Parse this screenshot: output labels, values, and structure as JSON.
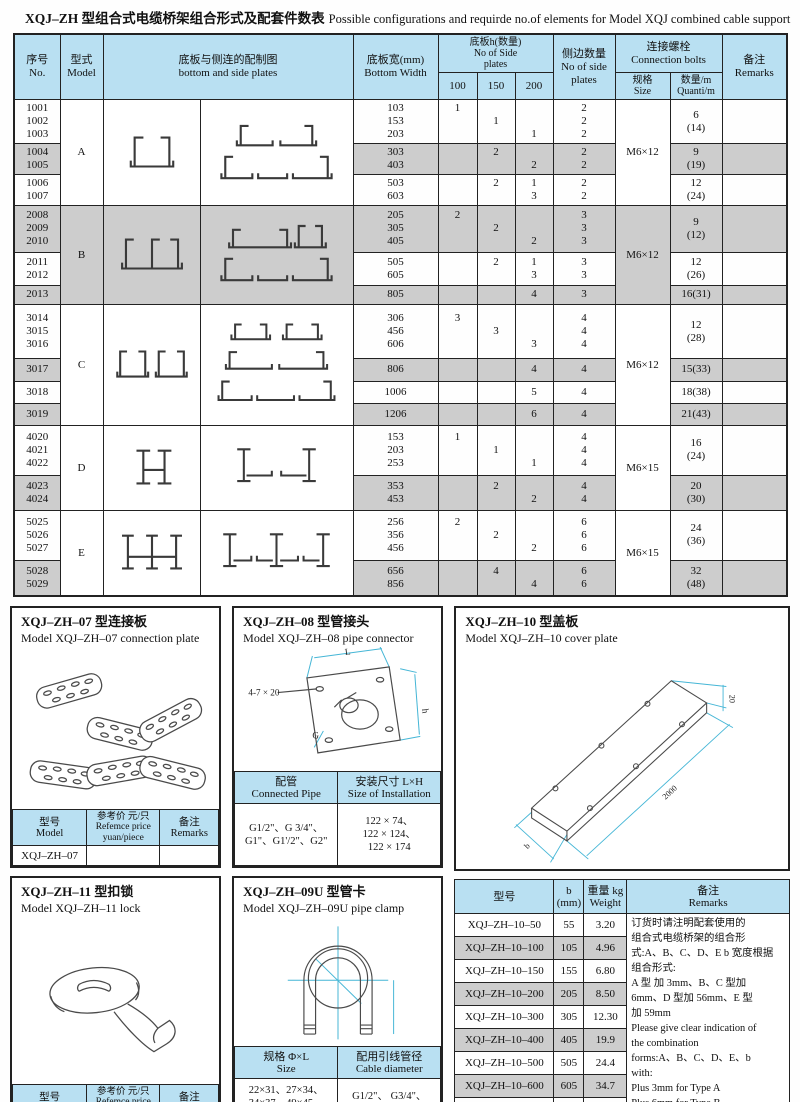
{
  "title": {
    "zh": "XQJ–ZH 型组合式电缆桥架组合形式及配套件数表",
    "en": "Possible configurations and requirde no.of elements for Model XQJ combined cable support"
  },
  "main_table": {
    "header": {
      "no": "序号\nNo.",
      "model": "型式\nModel",
      "plates": "底板与侧连的配制图\nbottom and side plates",
      "width": "底板宽(mm)\nBottom Width",
      "h_plates": "底板h(数量)\nNo of Side\nplates",
      "h100": "100",
      "h150": "150",
      "h200": "200",
      "sides": "侧边数量\nNo of side\nplates",
      "bolts": "连接螺栓\nConnection bolts",
      "bolt_size": "规格\nSize",
      "bolt_qty": "数量/m\nQuanti/m",
      "remarks": "备注\nRemarks"
    },
    "groups": [
      {
        "model": "A",
        "bolt_size": "M6×12",
        "subs": [
          {
            "models": [
              "1001",
              "1002",
              "1003"
            ],
            "widths": [
              "103",
              "153",
              "203"
            ],
            "h100": [
              "1",
              "",
              ""
            ],
            "h150": [
              "",
              "1",
              ""
            ],
            "h200": [
              "",
              "",
              "1"
            ],
            "sides": [
              "2",
              "2",
              "2"
            ],
            "qty": "6\n(14)"
          },
          {
            "models": [
              "1004",
              "1005"
            ],
            "widths": [
              "303",
              "403"
            ],
            "h100": [
              "",
              ""
            ],
            "h150": [
              "2",
              ""
            ],
            "h200": [
              "",
              "2"
            ],
            "sides": [
              "2",
              "2"
            ],
            "qty": "9\n(19)"
          },
          {
            "models": [
              "1006",
              "1007"
            ],
            "widths": [
              "503",
              "603"
            ],
            "h100": [
              "",
              ""
            ],
            "h150": [
              "2",
              ""
            ],
            "h200": [
              "1",
              "3"
            ],
            "sides": [
              "2",
              "2"
            ],
            "qty": "12\n(24)"
          }
        ]
      },
      {
        "model": "B",
        "bolt_size": "M6×12",
        "subs": [
          {
            "models": [
              "2008",
              "2009",
              "2010"
            ],
            "widths": [
              "205",
              "305",
              "405"
            ],
            "h100": [
              "2",
              "",
              ""
            ],
            "h150": [
              "",
              "2",
              ""
            ],
            "h200": [
              "",
              "",
              "2"
            ],
            "sides": [
              "3",
              "3",
              "3"
            ],
            "qty": "9\n(12)"
          },
          {
            "models": [
              "2011",
              "2012"
            ],
            "widths": [
              "505",
              "605"
            ],
            "h100": [
              "",
              ""
            ],
            "h150": [
              "2",
              ""
            ],
            "h200": [
              "1",
              "3"
            ],
            "sides": [
              "3",
              "3"
            ],
            "qty": "12\n(26)"
          },
          {
            "models": [
              "2013"
            ],
            "widths": [
              "805"
            ],
            "h100": [
              ""
            ],
            "h150": [
              ""
            ],
            "h200": [
              "4"
            ],
            "sides": [
              "3"
            ],
            "qty": "16(31)"
          }
        ]
      },
      {
        "model": "C",
        "bolt_size": "M6×12",
        "subs": [
          {
            "models": [
              "3014",
              "3015",
              "3016"
            ],
            "widths": [
              "306",
              "456",
              "606"
            ],
            "h100": [
              "3",
              "",
              ""
            ],
            "h150": [
              "",
              "3",
              ""
            ],
            "h200": [
              "",
              "",
              "3"
            ],
            "sides": [
              "4",
              "4",
              "4"
            ],
            "qty": "12\n(28)"
          },
          {
            "models": [
              "3017"
            ],
            "widths": [
              "806"
            ],
            "h100": [
              ""
            ],
            "h150": [
              ""
            ],
            "h200": [
              "4"
            ],
            "sides": [
              "4"
            ],
            "qty": "15(33)"
          },
          {
            "models": [
              "3018"
            ],
            "widths": [
              "1006"
            ],
            "h100": [
              ""
            ],
            "h150": [
              ""
            ],
            "h200": [
              "5"
            ],
            "sides": [
              "4"
            ],
            "qty": "18(38)"
          },
          {
            "models": [
              "3019"
            ],
            "widths": [
              "1206"
            ],
            "h100": [
              ""
            ],
            "h150": [
              ""
            ],
            "h200": [
              "6"
            ],
            "sides": [
              "4"
            ],
            "qty": "21(43)"
          }
        ]
      },
      {
        "model": "D",
        "bolt_size": "M6×15",
        "subs": [
          {
            "models": [
              "4020",
              "4021",
              "4022"
            ],
            "widths": [
              "153",
              "203",
              "253"
            ],
            "h100": [
              "1",
              "",
              ""
            ],
            "h150": [
              "",
              "1",
              ""
            ],
            "h200": [
              "",
              "",
              "1"
            ],
            "sides": [
              "4",
              "4",
              "4"
            ],
            "qty": "16\n(24)"
          },
          {
            "models": [
              "4023",
              "4024"
            ],
            "widths": [
              "353",
              "453"
            ],
            "h100": [
              "",
              ""
            ],
            "h150": [
              "2",
              ""
            ],
            "h200": [
              "",
              "2"
            ],
            "sides": [
              "4",
              "4"
            ],
            "qty": "20\n(30)"
          }
        ]
      },
      {
        "model": "E",
        "bolt_size": "M6×15",
        "subs": [
          {
            "models": [
              "5025",
              "5026",
              "5027"
            ],
            "widths": [
              "256",
              "356",
              "456"
            ],
            "h100": [
              "2",
              "",
              ""
            ],
            "h150": [
              "",
              "2",
              ""
            ],
            "h200": [
              "",
              "",
              "2"
            ],
            "sides": [
              "6",
              "6",
              "6"
            ],
            "qty": "24\n(36)"
          },
          {
            "models": [
              "5028",
              "5029"
            ],
            "widths": [
              "656",
              "856"
            ],
            "h100": [
              "",
              ""
            ],
            "h150": [
              "4",
              ""
            ],
            "h200": [
              "",
              "4"
            ],
            "sides": [
              "6",
              "6"
            ],
            "qty": "32\n(48)"
          }
        ]
      }
    ]
  },
  "sections": {
    "zh07": {
      "title_zh": "XQJ–ZH–07 型连接板",
      "title_en": "Model XQJ–ZH–07 connection plate",
      "headers": [
        "型号\nModel",
        "参考价 元/只\nRefemce price\nyuan/piece",
        "备注\nRemarks"
      ],
      "row": [
        "XQJ–ZH–07",
        "",
        ""
      ]
    },
    "zh08": {
      "title_zh": "XQJ–ZH–08 型管接头",
      "title_en": "Model XQJ–ZH–08 pipe connector",
      "labels": {
        "holes": "4-7 × 20",
        "L": "L",
        "h": "h",
        "G": "G"
      },
      "headers": [
        "配管\nConnected Pipe",
        "安装尺寸 L×H\nSize of Installation"
      ],
      "row": [
        "G1/2\"、G 3/4\"、\nG1\"、G1'/2\"、G2\"",
        "122 × 74、\n122 × 124、\n122 × 174"
      ]
    },
    "zh10": {
      "title_zh": "XQJ–ZH–10 型盖板",
      "title_en": "Model XQJ–ZH–10 cover plate",
      "labels": {
        "thickness": "20",
        "length": "2000",
        "width": "b"
      }
    },
    "zh11": {
      "title_zh": "XQJ–ZH–11 型扣锁",
      "title_en": "Model XQJ–ZH–11 lock",
      "headers": [
        "型号\nModel",
        "参考价 元/只\nRefemce price\nyuan/piece",
        "备注\nRemarks"
      ],
      "row": [
        "XQJ–ZH–11",
        "",
        ""
      ]
    },
    "zh09u": {
      "title_zh": "XQJ–ZH–09U 型管卡",
      "title_en": "Model XQJ–ZH–09U pipe clamp",
      "headers": [
        "规格 Φ×L\nSize",
        "配用引线管径\nCable diameter"
      ],
      "row": [
        "22×31、27×34、\n34×37、49×45、\n61×50、76×57、\n89×64",
        "G1/2\"、 G3/4\"、\nG1\"、 G1'/2\"、\nG2\"、 G2'/2\"、 G3\""
      ]
    },
    "zh10_table": {
      "headers": [
        "型号",
        "b\n(mm)",
        "重量 kg\nWeight",
        "备注\nRemarks"
      ],
      "rows": [
        [
          "XQJ–ZH–10–50",
          "55",
          "3.20"
        ],
        [
          "XQJ–ZH–10–100",
          "105",
          "4.96"
        ],
        [
          "XQJ–ZH–10–150",
          "155",
          "6.80"
        ],
        [
          "XQJ–ZH–10–200",
          "205",
          "8.50"
        ],
        [
          "XQJ–ZH–10–300",
          "305",
          "12.30"
        ],
        [
          "XQJ–ZH–10–400",
          "405",
          "19.9"
        ],
        [
          "XQJ–ZH–10–500",
          "505",
          "24.4"
        ],
        [
          "XQJ–ZH–10–600",
          "605",
          "34.7"
        ],
        [
          "XQJ–ZH–10–700",
          "705",
          "43.5"
        ],
        [
          "XQJ–ZH–10–800",
          "805",
          "49.5"
        ]
      ],
      "remarks": "订货时请注明配套使用的\n组合式电缆桥架的组合形\n式:A、B、C、D、E b 宽度根据\n组合形式:\nA 型 加 3mm、B、C 型加\n6mm、D 型加 56mm、E 型\n加 59mm\nPlease give clear indication of\nthe combination\nforms:A、B、C、D、E、b\nwith:\nPlus 3mm for Type A\nPlus 6mm for Type B\nPlus 56mm for Type D\nPlus 59mm for Type E"
    }
  },
  "colors": {
    "header_blue": "#b9e0f2",
    "row_gray": "#cdcdcd",
    "dim_cyan": "#45b6d6"
  }
}
